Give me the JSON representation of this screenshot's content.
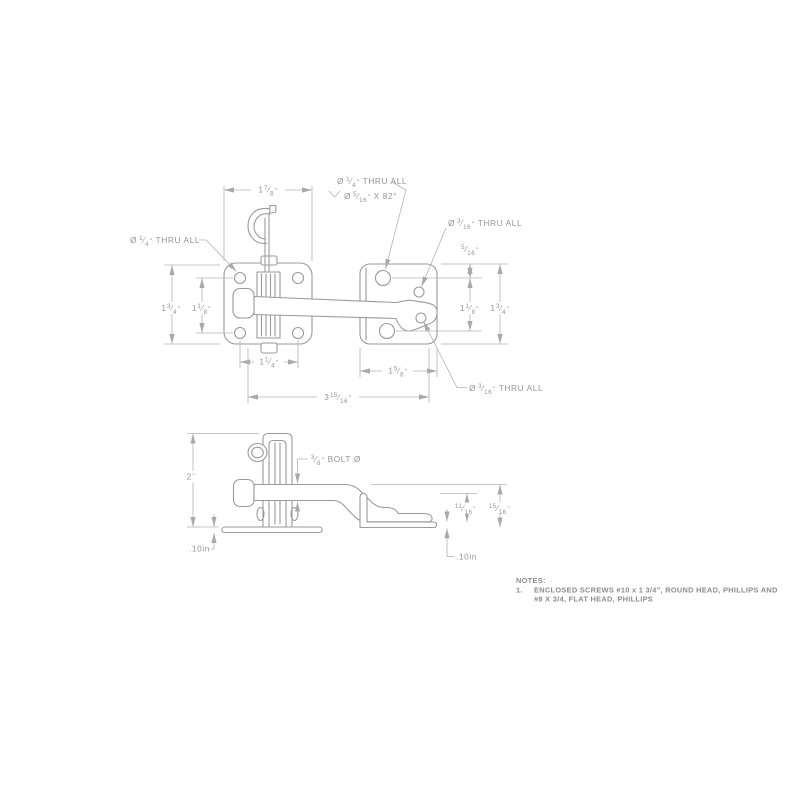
{
  "g": {
    "dia": "Ø",
    "sl": "⁄",
    "in": "\""
  },
  "top": {
    "pw": {
      "w": "1",
      "n": "7",
      "d": "8"
    },
    "lo": {
      "w": "1",
      "n": "3",
      "d": "4"
    },
    "li": {
      "w": "1",
      "n": "1",
      "d": "8"
    },
    "bl": {
      "w": "1",
      "n": "1",
      "d": "4"
    },
    "br": {
      "w": "1",
      "n": "5",
      "d": "8"
    },
    "ov": {
      "w": "3",
      "n": "15",
      "d": "16"
    },
    "ro": {
      "n": "5",
      "d": "16"
    },
    "ri": {
      "w": "1",
      "n": "1",
      "d": "8"
    },
    "rh": {
      "w": "1",
      "n": "3",
      "d": "4"
    },
    "c_left": {
      "n": "1",
      "d": "4",
      "suffix": "THRU ALL"
    },
    "c_top1": {
      "n": "1",
      "d": "4",
      "suffix": "THRU ALL"
    },
    "c_top2": {
      "n": "5",
      "d": "16",
      "suffix": "X 82°"
    },
    "c_right": {
      "n": "3",
      "d": "16",
      "suffix": "THRU ALL"
    },
    "c_bottom": {
      "n": "3",
      "d": "16",
      "suffix": "THRU ALL"
    }
  },
  "side": {
    "h2": "2",
    "bolt": {
      "n": "3",
      "d": "8",
      "suffix": "BOLT Ø"
    },
    "ci": {
      "n": "11",
      "d": "16"
    },
    "co": {
      "n": "15",
      "d": "16"
    },
    "tl": ".10in",
    "tr": ".10in"
  },
  "notes": {
    "title": "NOTES:",
    "no": "1.",
    "line1": "ENCLOSED SCREWS #10 x 1 3/4\", ROUND HEAD, PHILLIPS AND",
    "line2": "#8 X 3/4, FLAT HEAD, PHILLIPS"
  }
}
